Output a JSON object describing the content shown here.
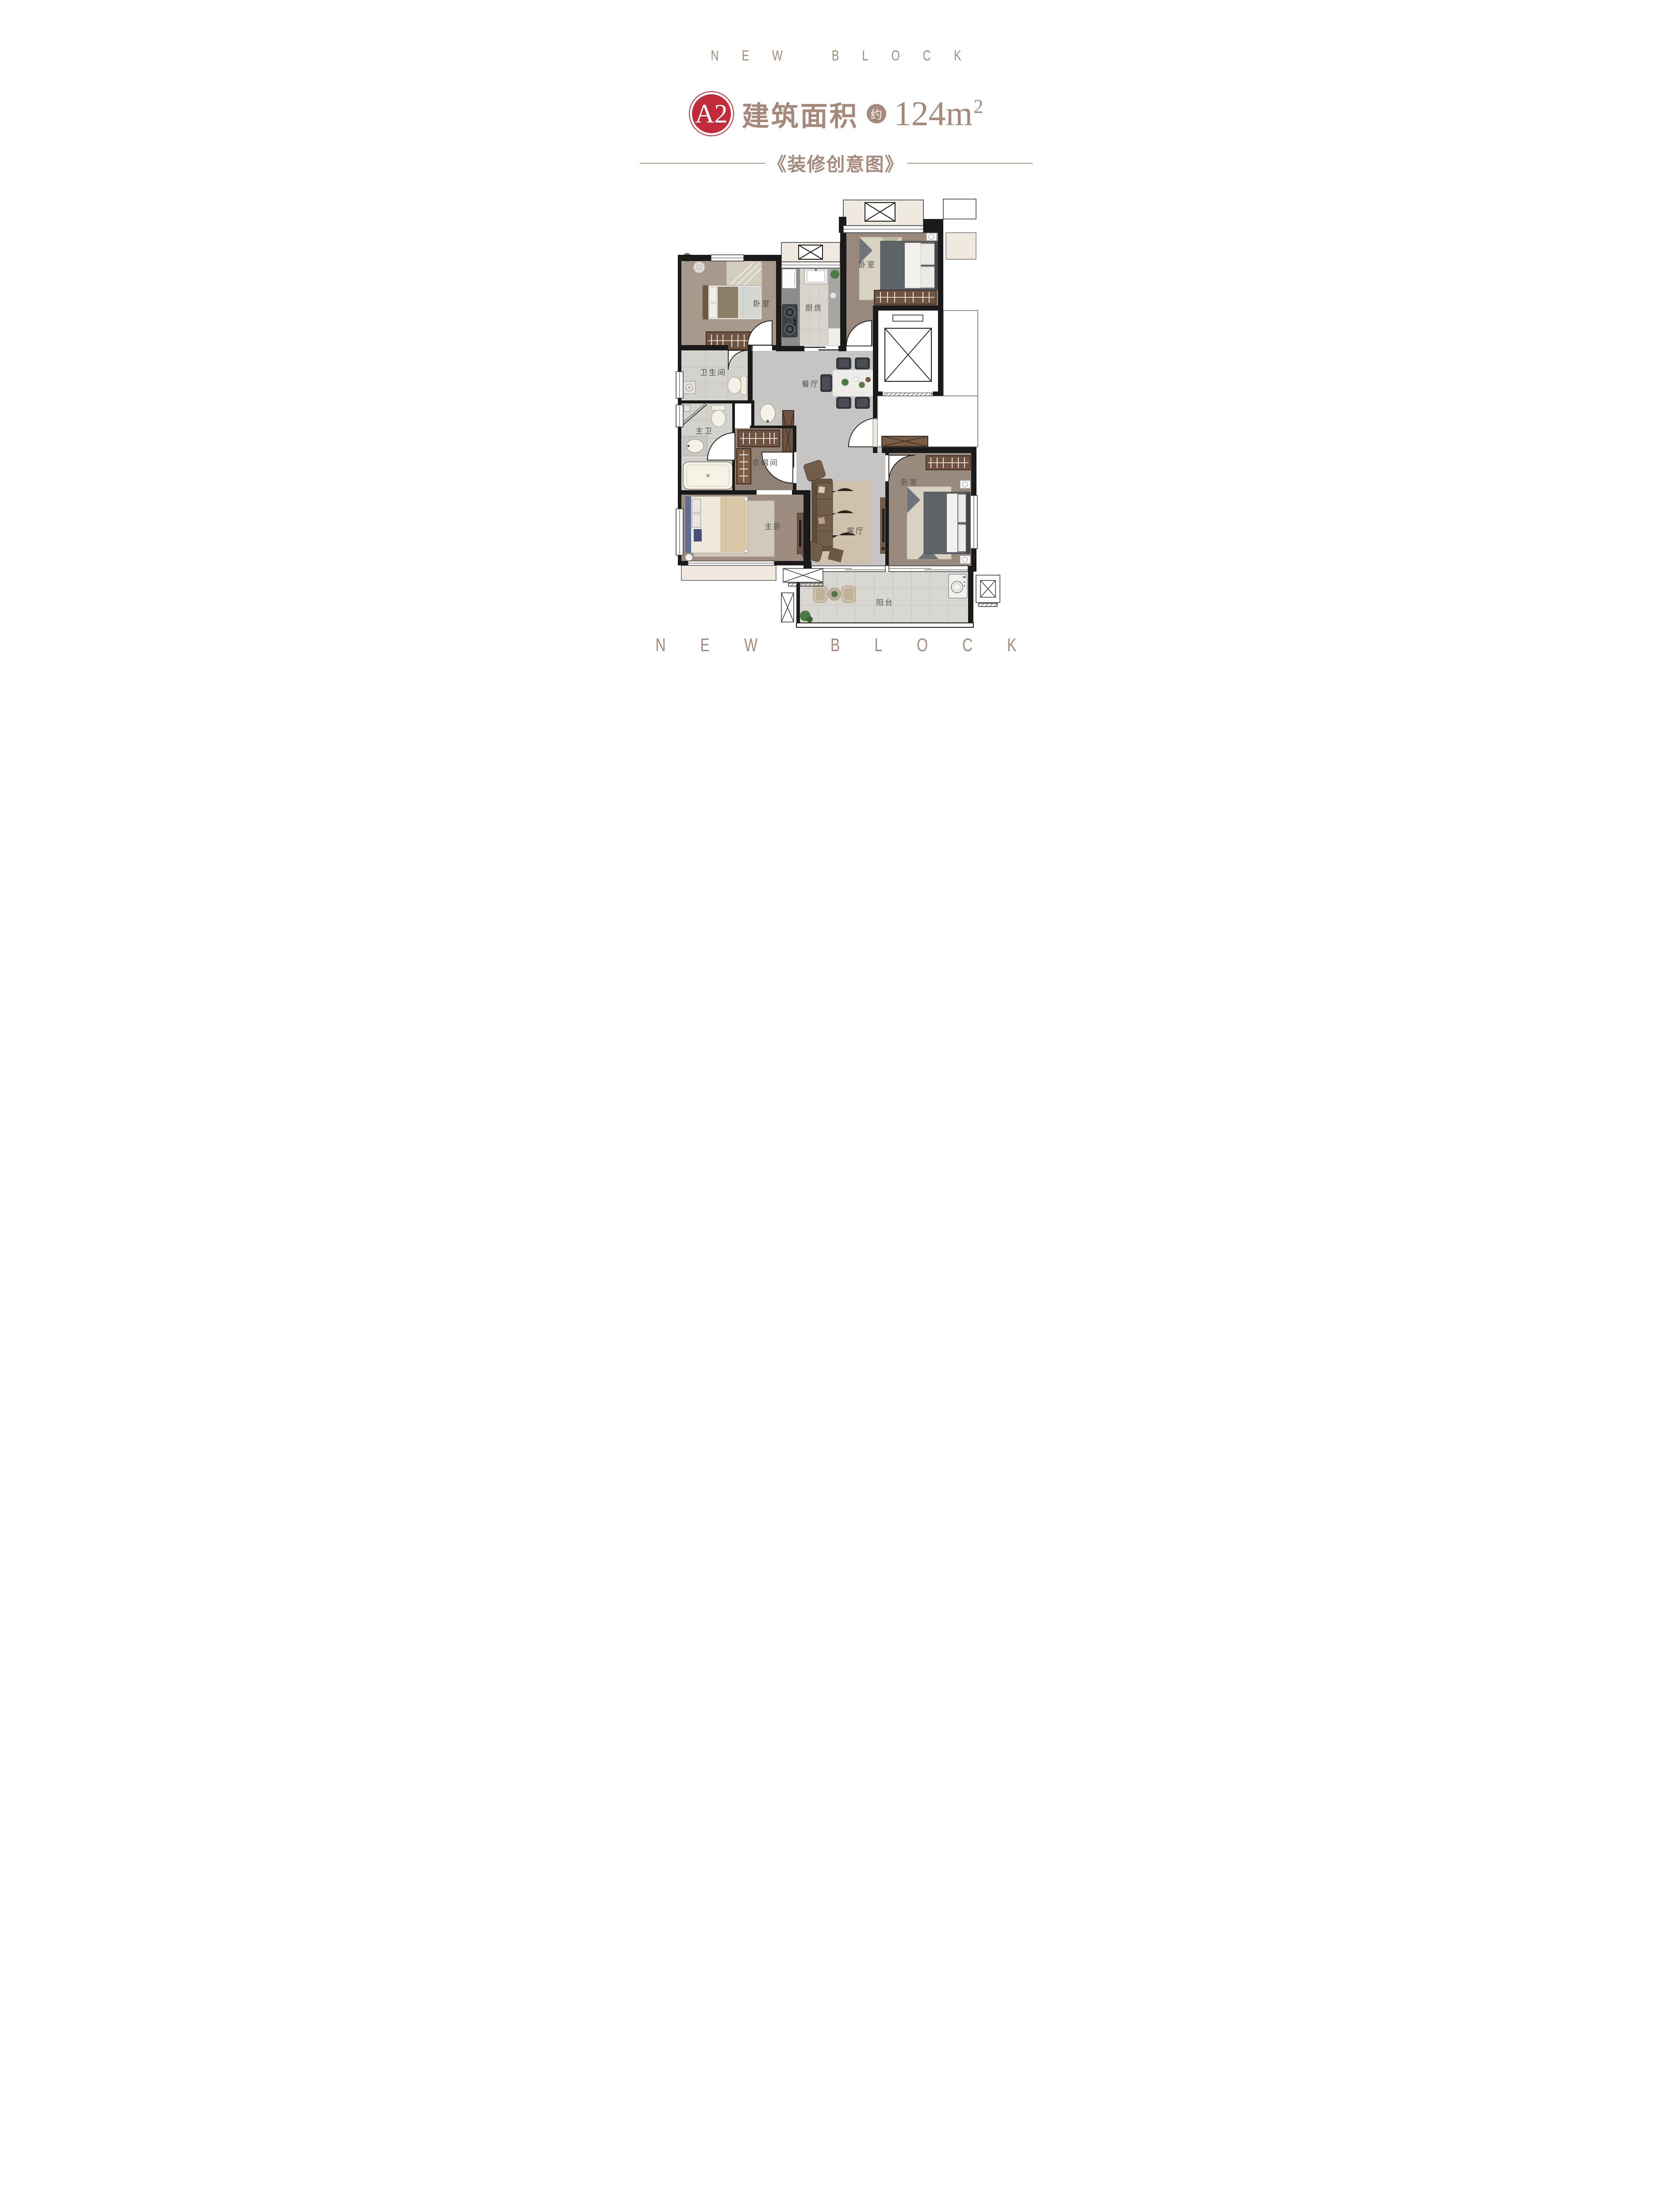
{
  "brand": {
    "top": "NEW BLOCK",
    "bottom": "NEW BLOCK"
  },
  "header": {
    "unit_badge": "A2",
    "title": "建筑面积",
    "approx_label": "约",
    "area_value": "124",
    "area_unit": "m",
    "area_unit_sup": "2",
    "subtitle": "《装修创意图》"
  },
  "colors": {
    "brand_tan": "#a6897a",
    "badge_red": "#c12b3a",
    "wall_black": "#1a1a1a",
    "wood_floor": "#9d8d80",
    "marble_gray": "#c6c5c3",
    "tile_light": "#d8d5cf",
    "wardrobe_brown": "#6e5342"
  },
  "floor_plan": {
    "rooms": [
      {
        "id": "bedroom-top-left",
        "label": "卧室"
      },
      {
        "id": "kitchen",
        "label": "厨房"
      },
      {
        "id": "bedroom-top-right",
        "label": "卧室"
      },
      {
        "id": "bathroom",
        "label": "卫生间"
      },
      {
        "id": "dining-room",
        "label": "餐厅"
      },
      {
        "id": "master-bathroom",
        "label": "主卫"
      },
      {
        "id": "cloakroom",
        "label": "衣帽间"
      },
      {
        "id": "master-bedroom",
        "label": "主卧"
      },
      {
        "id": "living-room",
        "label": "客厅"
      },
      {
        "id": "bedroom-right",
        "label": "卧室"
      },
      {
        "id": "balcony",
        "label": "阳台"
      }
    ]
  }
}
